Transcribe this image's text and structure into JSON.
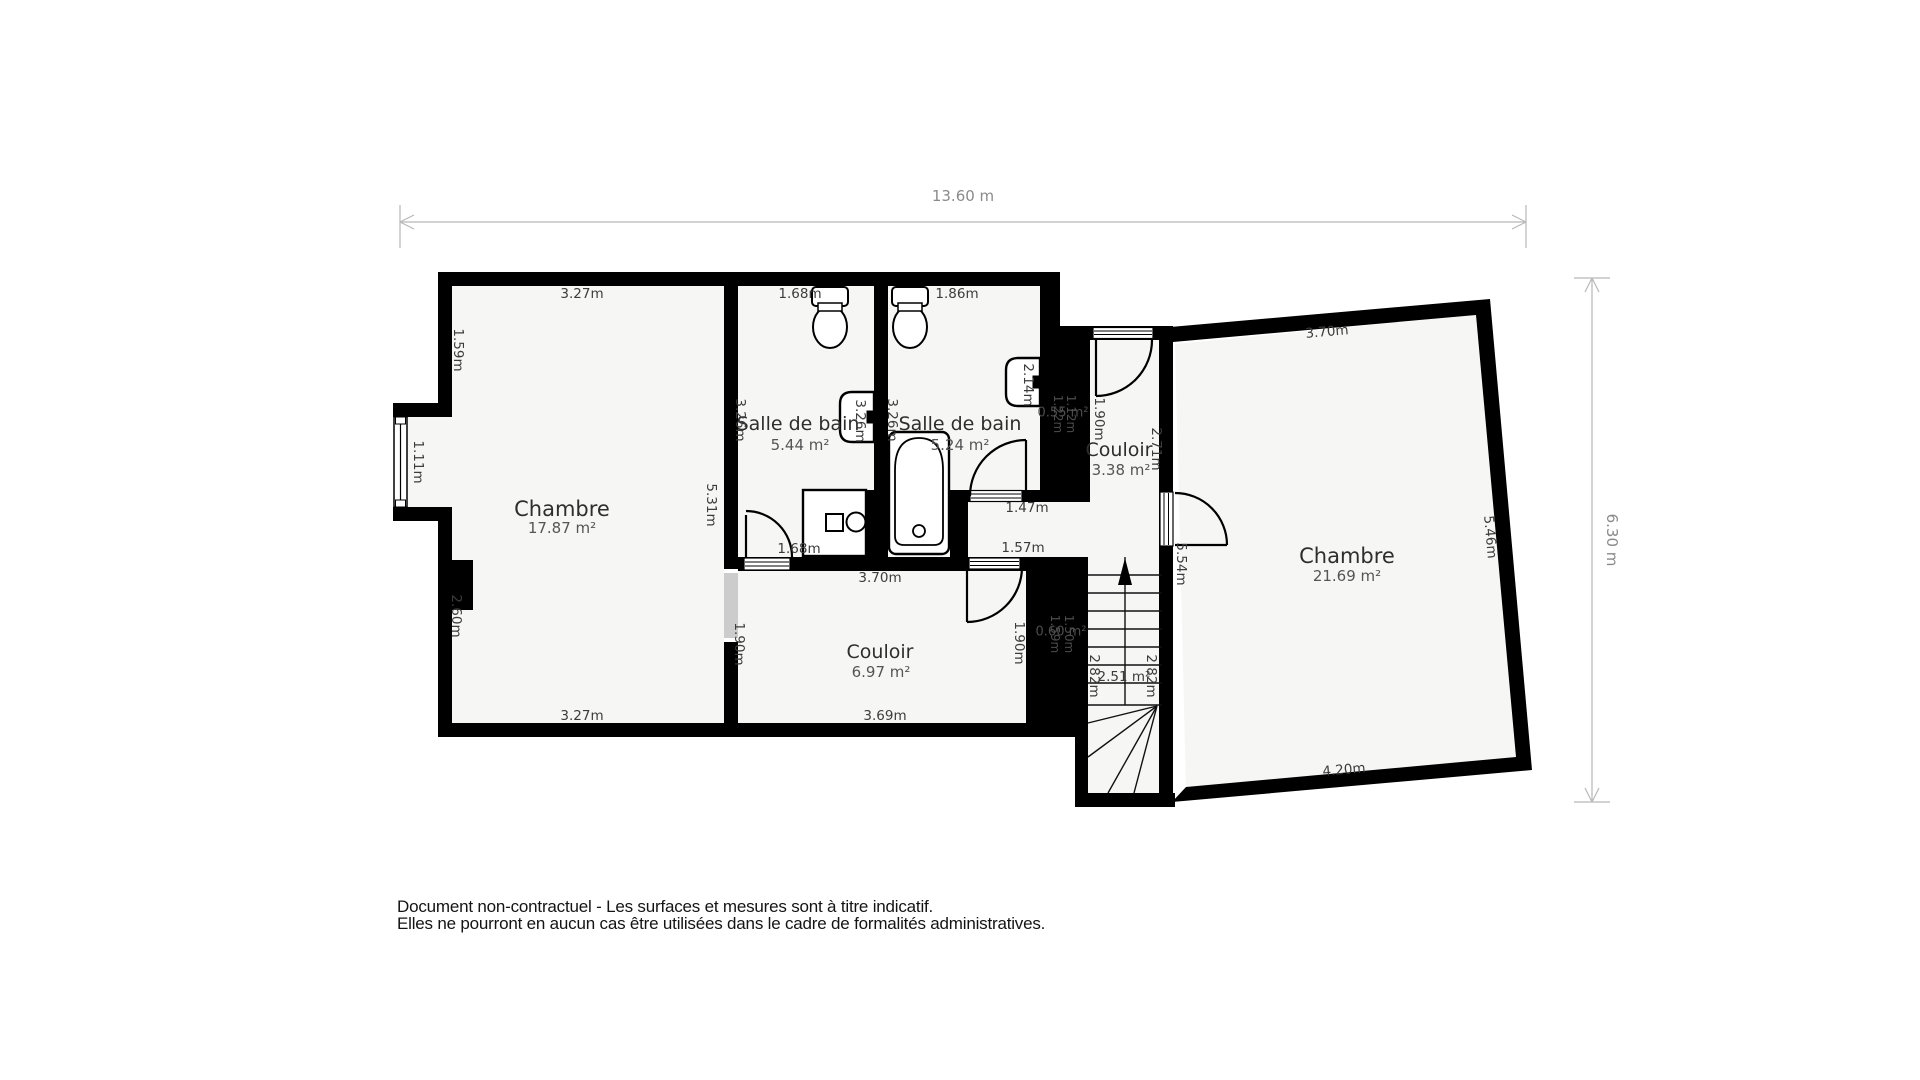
{
  "dimensions": {
    "overall_width": "13.60 m",
    "overall_height": "6.30 m"
  },
  "rooms": {
    "chambre_left": {
      "name": "Chambre",
      "area": "17.87 m²",
      "dims": {
        "top": "3.27m",
        "bottom": "3.27m",
        "left_upper": "1.59m",
        "window": "1.11m",
        "chimney": "2.60m",
        "right": "5.31m"
      }
    },
    "bath1": {
      "name": "Salle de bain",
      "area": "5.44 m²",
      "dims": {
        "top": "1.68m",
        "left": "3.26m",
        "right": "3.26m",
        "door": "1.68m"
      }
    },
    "bath2": {
      "name": "Salle de bain",
      "area": "5.24 m²",
      "dims": {
        "top": "1.86m",
        "left": "3.26m",
        "sink_wall": "2.14m"
      }
    },
    "couloir_small": {
      "name": "Couloir",
      "area": "3.38 m²",
      "dims": {
        "left": "1.90m",
        "right": "2.71m"
      }
    },
    "couloir_main": {
      "name": "Couloir",
      "area": "6.97 m²",
      "dims": {
        "top": "3.70m",
        "bottom": "3.69m",
        "left": "1.90m",
        "right": "1.90m"
      }
    },
    "chambre_right": {
      "name": "Chambre",
      "area": "21.69 m²",
      "dims": {
        "top": "3.70m",
        "right": "5.46m",
        "bottom": "4.20m",
        "left": "5.54m"
      }
    },
    "hall": {
      "dims": {
        "door_upper": "1.47m",
        "door_lower": "1.57m"
      }
    },
    "shaft_upper": {
      "area": "0.55 m²",
      "dims": {
        "a": "1.22m",
        "b": "1.12m"
      }
    },
    "shaft_lower": {
      "area": "0.60 m²",
      "dims": {
        "a": "1.59m",
        "b": "1.50m"
      }
    },
    "stairs": {
      "area": "2.51 m²",
      "dims": {
        "left": "2.82m",
        "right": "2.82m"
      }
    }
  },
  "disclaimer": {
    "line1": "Document non-contractuel - Les surfaces et mesures sont à titre indicatif.",
    "line2": "Elles ne pourront en aucun cas être utilisées dans le cadre de formalités administratives."
  }
}
